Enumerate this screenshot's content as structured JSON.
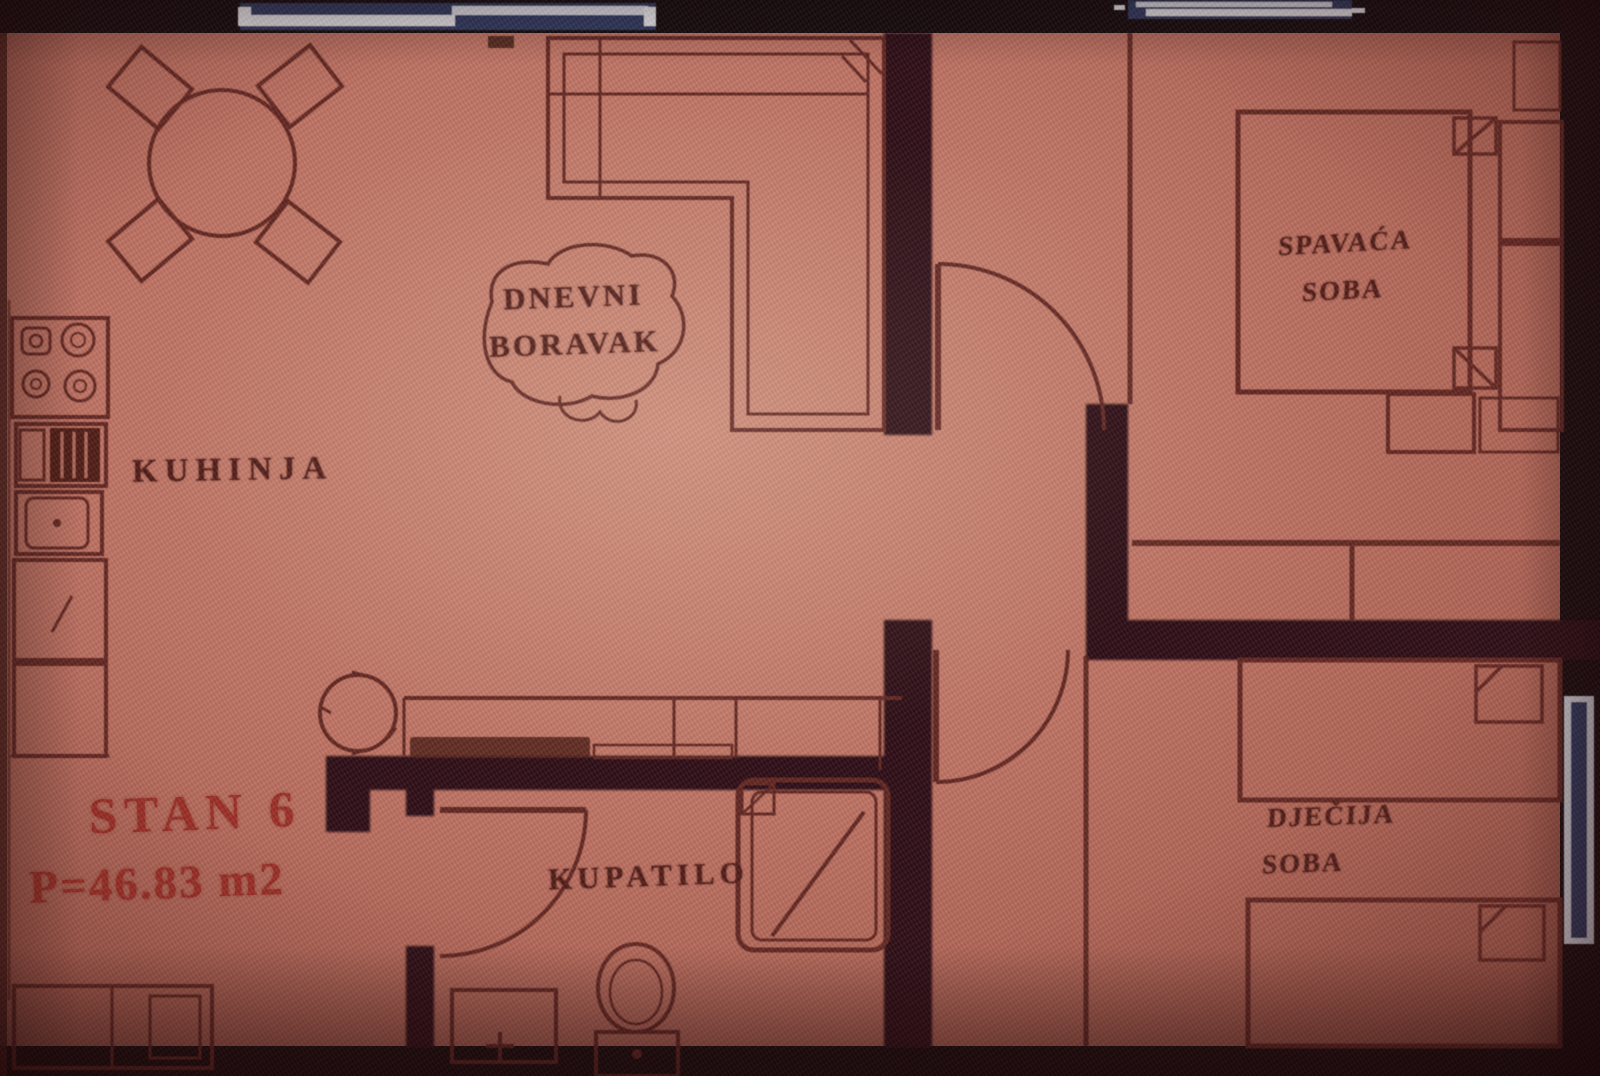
{
  "plan": {
    "apartment_title": "STAN 6",
    "apartment_area": "P=46.83 m2",
    "rooms": {
      "kitchen": {
        "label": "KUHINJA"
      },
      "living_room": {
        "label_line1": "DNEVNI",
        "label_line2": "BORAVAK"
      },
      "bathroom": {
        "label": "KUPATILO"
      },
      "bedroom": {
        "label_line1": "SPAVAĆA",
        "label_line2": "SOBA"
      },
      "children_room": {
        "label_line1": "DJEČIJA",
        "label_line2": "SOBA"
      }
    },
    "colors": {
      "floor": "#bd7465",
      "floor_edge": "#8e4c40",
      "wall_thick": "#2b1013",
      "line_thin": "#5e2620",
      "label_text": "#4c1b17",
      "title_text": "#9a2e26",
      "photo_border": "#140a0c",
      "window_navy": "#2e3a64",
      "window_white": "#e8eaef"
    }
  }
}
